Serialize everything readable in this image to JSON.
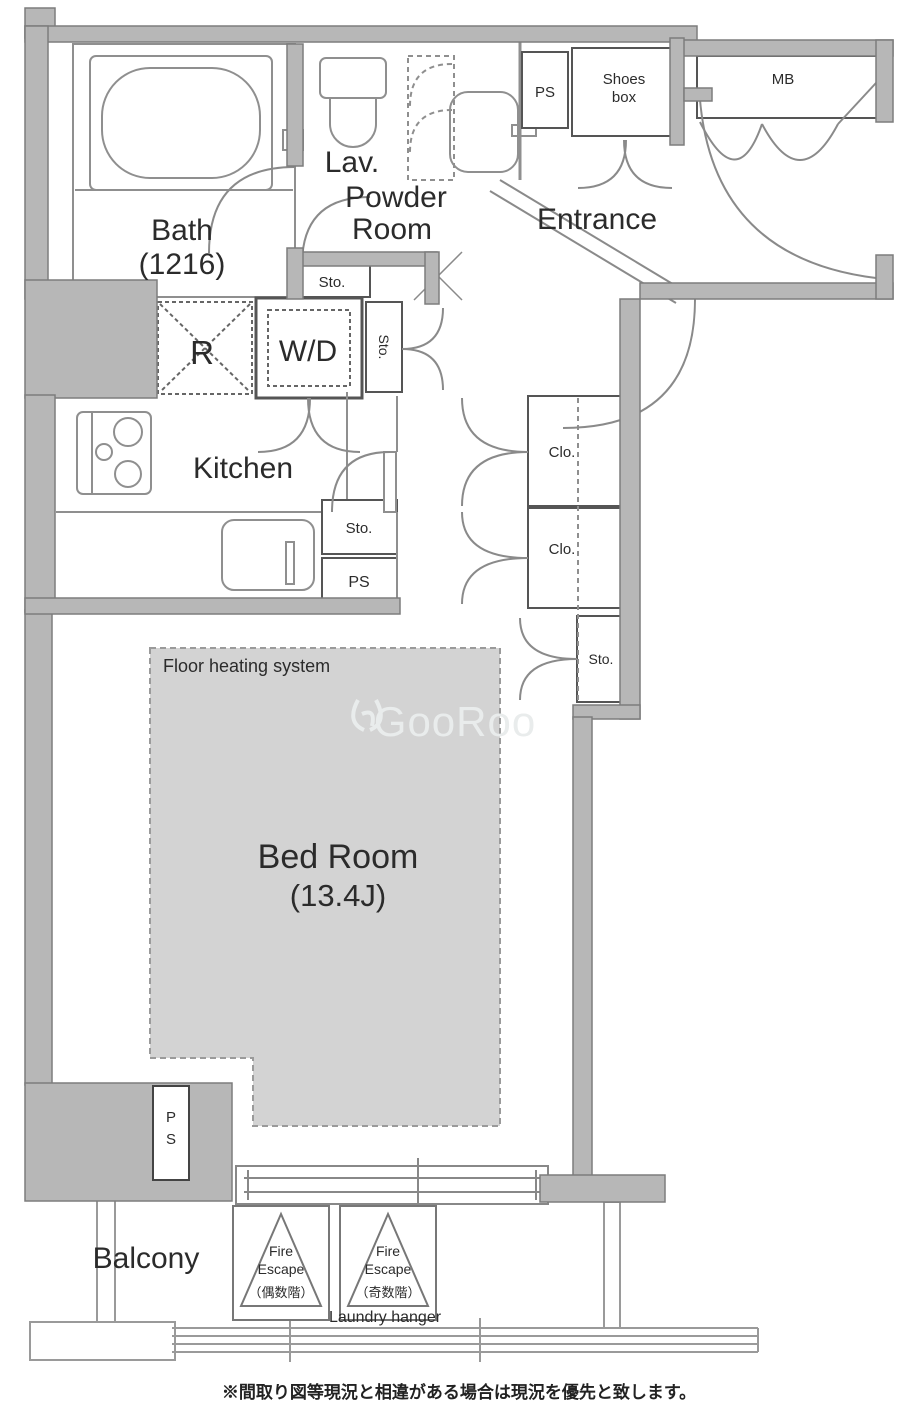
{
  "plan": {
    "rooms": {
      "bath": "Bath",
      "bath_size": "(1216)",
      "lav": "Lav.",
      "powder_1": "Powder",
      "powder_2": "Room",
      "entrance": "Entrance",
      "kitchen": "Kitchen",
      "bedroom": "Bed Room",
      "bedroom_size": "(13.4J)",
      "balcony": "Balcony"
    },
    "fixtures": {
      "refrigerator": "R",
      "washer_dryer": "W/D",
      "storage": "Sto.",
      "pipe_space": "PS",
      "shoes_box_1": "Shoes",
      "shoes_box_2": "box",
      "meter_box": "MB",
      "closet": "Clo."
    },
    "labels": {
      "floor_heating": "Floor heating system",
      "laundry_hanger": "Laundry hanger",
      "fire": "Fire",
      "escape": "Escape",
      "even_floors": "（偶数階）",
      "odd_floors": "（奇数階）",
      "ps_vertical_1": "P",
      "ps_vertical_2": "S"
    },
    "watermark": "GooRoo",
    "disclaimer": "※間取り図等現況と相違がある場合は現況を優先と致します。",
    "colors": {
      "wall_fill": "#b7b7b7",
      "wall_stroke": "#7d7d7d",
      "line": "#8a8a8a",
      "text": "#2b2b2b",
      "heating_fill": "#d3d3d3",
      "watermark": "#e9ecec"
    }
  }
}
